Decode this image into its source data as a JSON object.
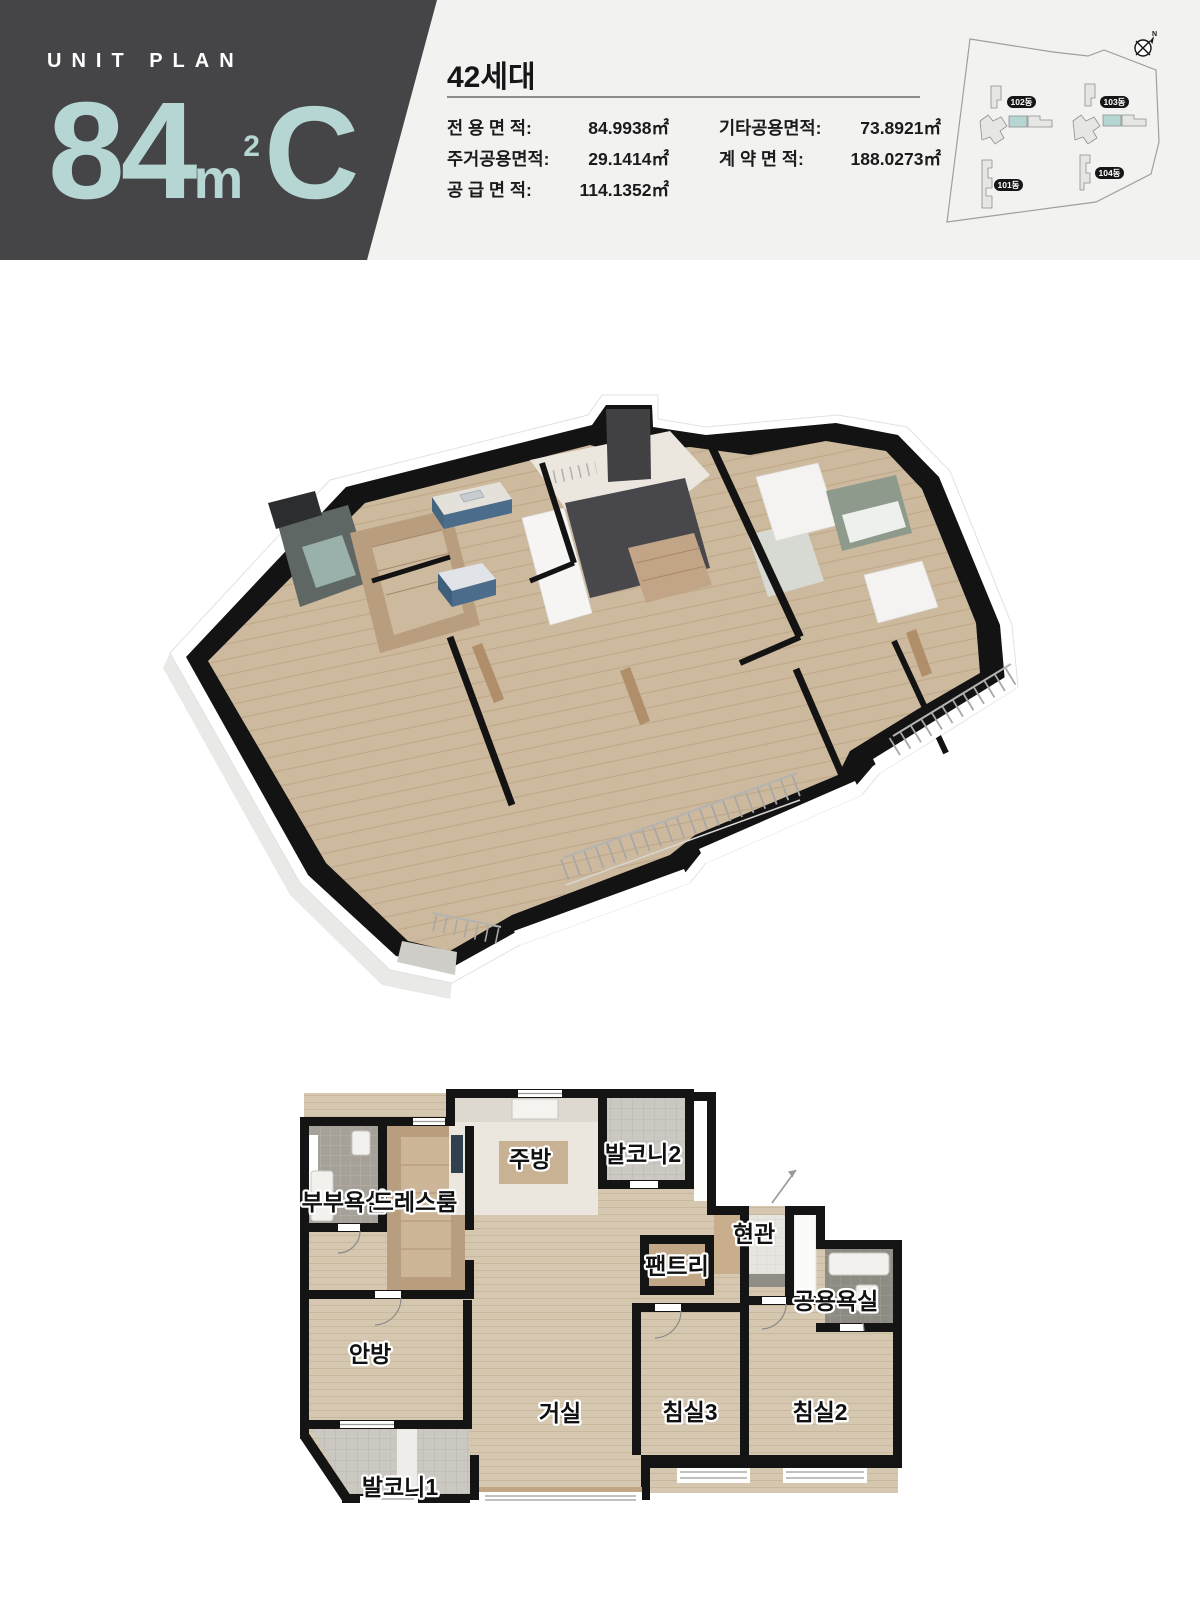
{
  "header": {
    "eyebrow": "UNIT PLAN",
    "unit": {
      "number": "84",
      "m": "m",
      "sup": "2",
      "type": "C"
    },
    "households": "42세대",
    "areas_left": [
      {
        "label": "전 용 면 적:",
        "value": "84.9938㎡"
      },
      {
        "label": "주거공용면적:",
        "value": "29.1414㎡"
      },
      {
        "label": "공 급 면 적:",
        "value": "114.1352㎡"
      }
    ],
    "areas_right": [
      {
        "label": "기타공용면적:",
        "value": "73.8921㎡"
      },
      {
        "label": "계 약 면 적:",
        "value": "188.0273㎡"
      }
    ]
  },
  "site_map": {
    "badges": [
      "102동",
      "103동",
      "101동",
      "104동"
    ],
    "compass": "N"
  },
  "plan2d": {
    "rooms": [
      {
        "label": "부부욕실"
      },
      {
        "label": "드레스룸"
      },
      {
        "label": "주방"
      },
      {
        "label": "발코니2"
      },
      {
        "label": "팬트리"
      },
      {
        "label": "현관"
      },
      {
        "label": "공용욕실"
      },
      {
        "label": "안방"
      },
      {
        "label": "거실"
      },
      {
        "label": "침실3"
      },
      {
        "label": "침실2"
      },
      {
        "label": "발코니1"
      }
    ]
  },
  "colors": {
    "accent_teal": "#b5d6d2",
    "header_block": "#454548",
    "band_bg": "#f2f2f1",
    "wall_black": "#141414",
    "wood_floor": "#d6c8b0",
    "kitchen_blue": "#4c6c8c"
  }
}
